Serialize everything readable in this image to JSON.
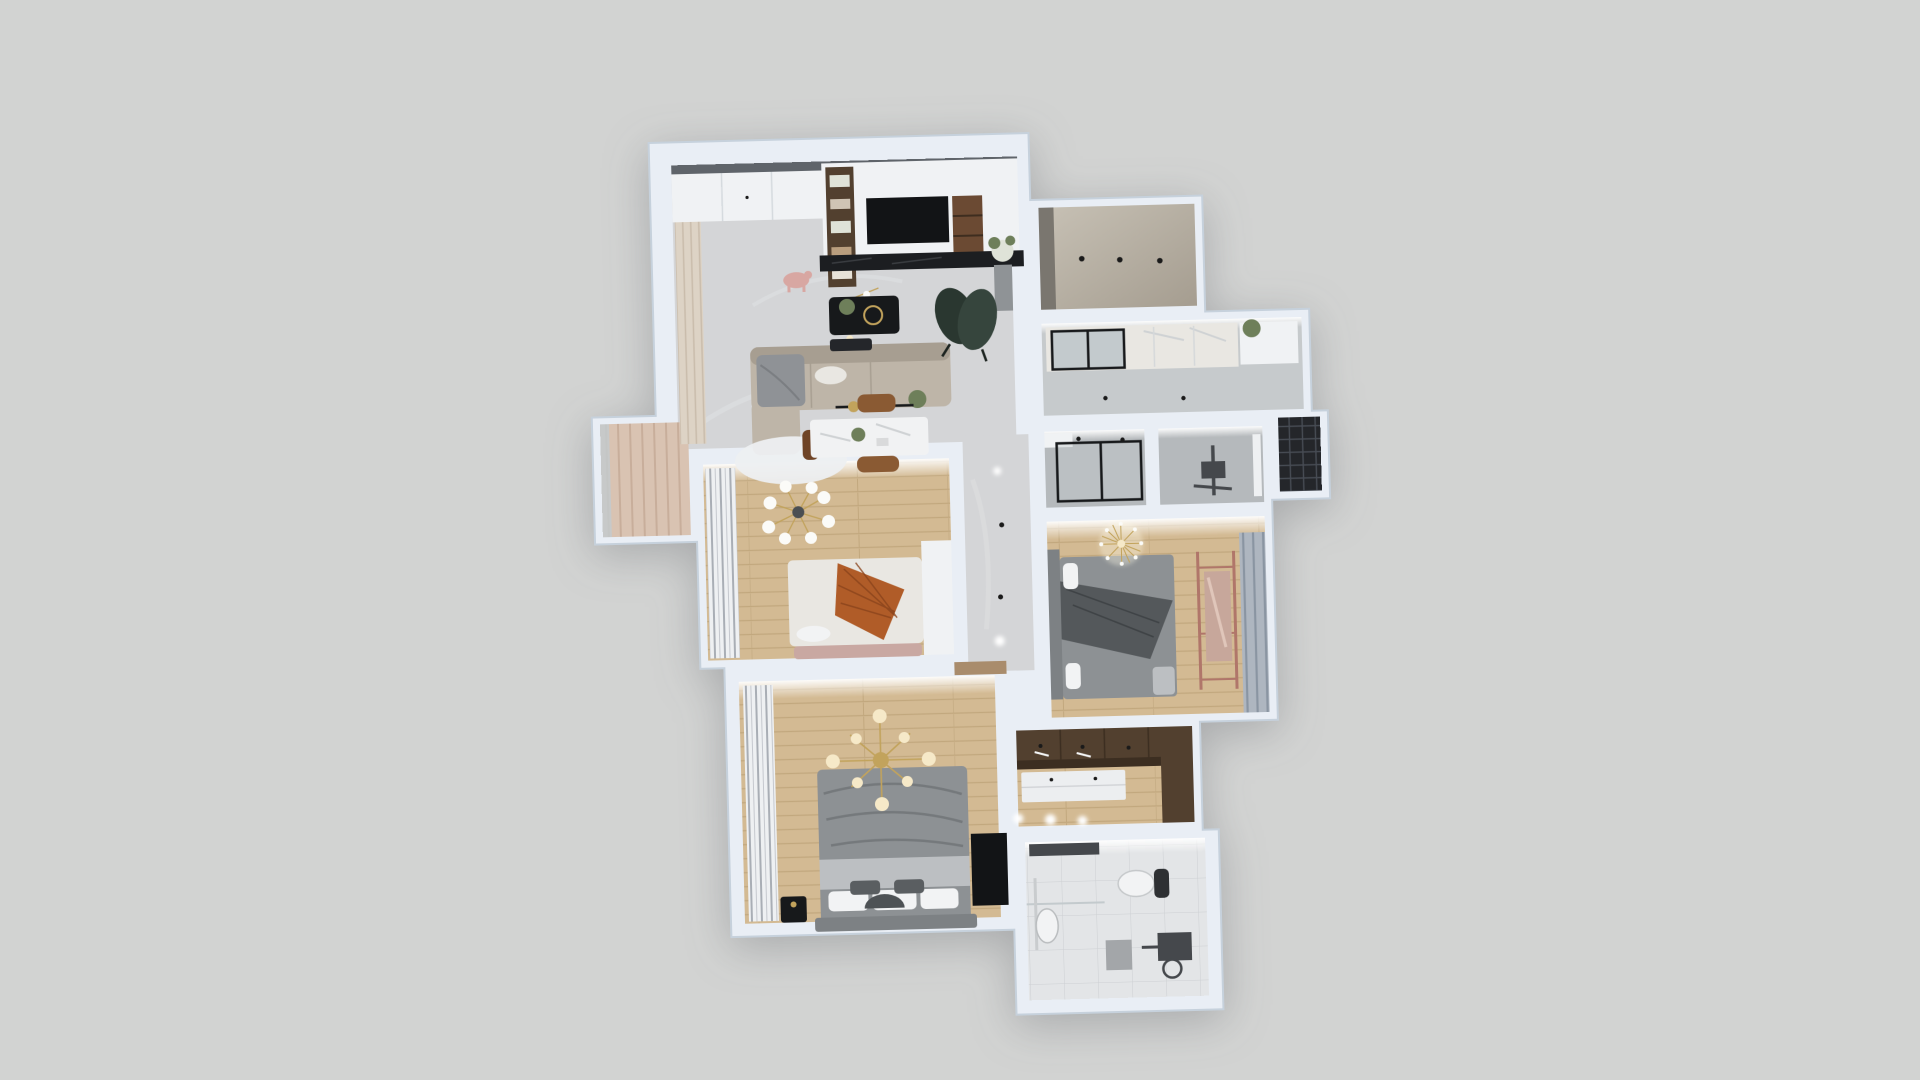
{
  "viewport": {
    "kind": "3d-floorplan-dollhouse-render",
    "rooms": [
      "living-dining-room",
      "entry-hall",
      "balcony",
      "multipurpose-room",
      "kitchen",
      "drying-balcony",
      "shower-bathroom",
      "utility-shower-room",
      "bedroom-small",
      "bedroom-guest",
      "master-bedroom",
      "walk-in-closet",
      "master-bathroom",
      "hallway"
    ],
    "lighting": {
      "bedroom_small_sputnik_bulbs": 8,
      "guest_bedroom_chandelier_style": "dandelion-burst",
      "master_chandelier_style": "gold-branch-cross",
      "living_pendant_globes": 6
    }
  },
  "colors": {
    "background": "#d2d3d2",
    "wall": "#e9eef5",
    "wallEdge": "#c6d1dc",
    "ceilingEdge": "#5f646a",
    "marbleFloor": "#d4d5d7",
    "marbleStreak": "#e4e5e7",
    "woodFloor": "#d3ba93",
    "woodLine": "#c2a87e",
    "concreteA": "#c7c1b5",
    "concreteB": "#a59d90",
    "tileFloor": "#b5b9bc",
    "tileLight": "#c6cacc",
    "bathFloor": "#e3e5e7",
    "balconyFloor": "#d9c3b2",
    "balconyStripe": "#c8ae9b",
    "latticeDark": "#24262a",
    "latticeLine": "#474c54",
    "curtainTan": "#ddd3c5",
    "curtainTanDark": "#c9bcab",
    "curtainGray": "#eef0f2",
    "curtainGrayDark": "#a9aeb5",
    "curtainBlue": "#aeb6c0",
    "curtainBlueDark": "#8a95a2",
    "whitePanel": "#f0f2f4",
    "sofa": "#beb5a8",
    "sofaDark": "#a79e91",
    "throwGray": "#8f9296",
    "rugWhite": "#edeff1",
    "chairGreen": "#36453d",
    "chairGreenDark": "#2a3730",
    "blackMarble": "#1c1e21",
    "tvBlack": "#121416",
    "walnut": "#52402f",
    "walnutDark": "#3c2e21",
    "shelfWood": "#6b4a33",
    "plantGreen": "#6e7f5a",
    "plantPale": "#dfe3d8",
    "pigPink": "#d8a7a2",
    "tableWhite": "#f1f2f3",
    "chairBrown": "#8a5a33",
    "chairBrownDark": "#6f4426",
    "gold": "#c2a35c",
    "warmGlobe": "#f6e9c8",
    "whiteGlobe": "#fbfbf8",
    "bedWhite": "#e9e7e2",
    "throwOrange": "#b05c28",
    "throwOrangeLine": "#8a431c",
    "benchPink": "#c9a8a2",
    "headboardGray": "#7d8184",
    "duvetGray": "#8d9194",
    "duvetDark": "#54585b",
    "sheetLight": "#bcbfc2",
    "pillowWhite": "#f2f3f4",
    "pillowDark": "#5a5e61",
    "copper": "#b0766a",
    "mirrorRose": "#c7a79b",
    "doorTan": "#a98c6c",
    "fixtureDark": "#45484c",
    "dresserWhite": "#eceef0",
    "glassTint": "#c3cacd",
    "frameBlack": "#17191b",
    "dotDark": "#1a1a1a",
    "lightWhite": "#ffffff",
    "grayCabinet": "#7a766f",
    "planterGray": "#8f9396"
  }
}
